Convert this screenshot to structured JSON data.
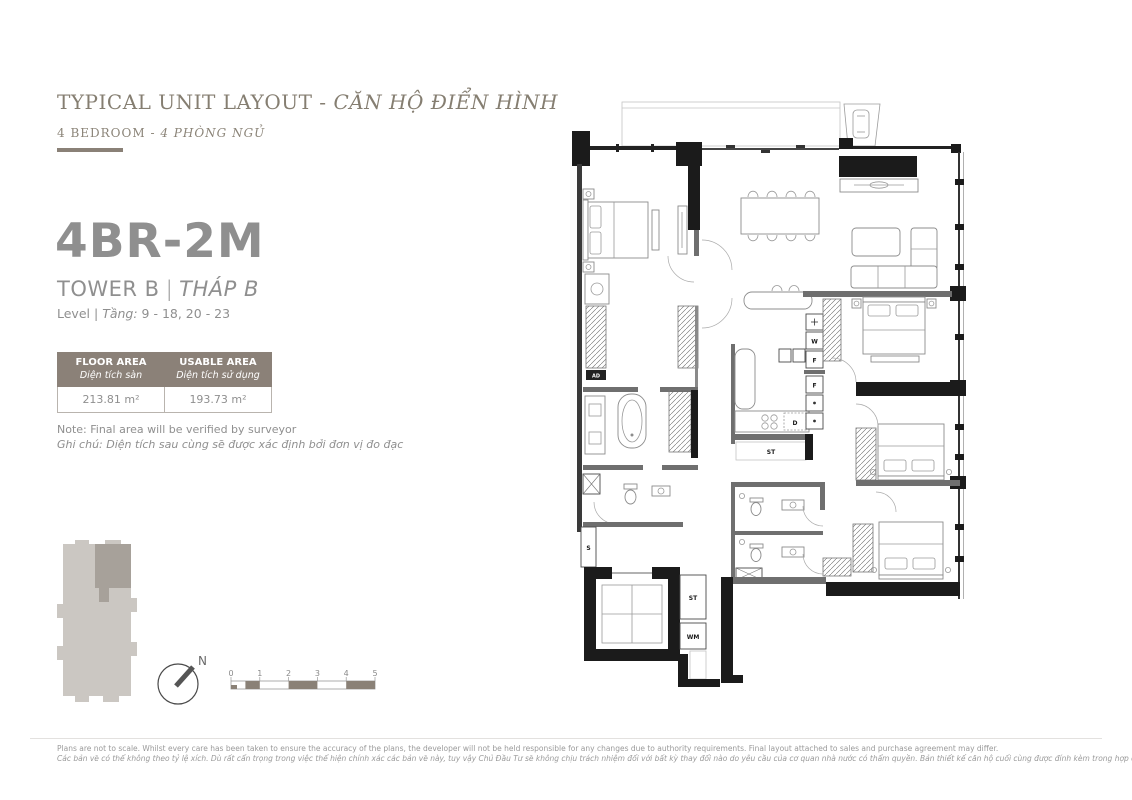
{
  "header": {
    "title_en": "TYPICAL UNIT LAYOUT",
    "title_divider": " - ",
    "title_vi": "CĂN HỘ ĐIỂN HÌNH",
    "subtitle_en": "4 BEDROOM",
    "subtitle_divider": " - ",
    "subtitle_vi": "4 PHÒNG NGỦ"
  },
  "unit": {
    "code": "4BR-2M",
    "tower_en": "TOWER B",
    "tower_sep": "|",
    "tower_vi": "THÁP B",
    "level_en": "Level",
    "level_sep": "|",
    "level_vi": "Tầng:",
    "level_value": "9 - 18, 20 - 23"
  },
  "area_table": {
    "col1": {
      "header_en": "FLOOR AREA",
      "header_vi": "Diện tích sàn",
      "value": "213.81 m²"
    },
    "col2": {
      "header_en": "USABLE AREA",
      "header_vi": "Diện tích sử dụng",
      "value": "193.73 m²"
    }
  },
  "notes": {
    "en": "Note: Final area will be verified by surveyor",
    "vi": "Ghi chú: Diện tích sau cùng sẽ được xác định bởi đơn vị đo đạc"
  },
  "plan_labels": {
    "w": "W",
    "f_upper": "F",
    "f_lower": "F",
    "d": "D",
    "st_kitchen": "ST",
    "st_store": "ST",
    "wm": "WM",
    "s": "S",
    "ad": "AD"
  },
  "compass": {
    "north": "N"
  },
  "scalebar": {
    "ticks": [
      "0",
      "1",
      "2",
      "3",
      "4",
      "5"
    ]
  },
  "footer": {
    "line_en": "Plans are not to scale. Whilst every care has been taken to ensure the accuracy of the plans, the developer will not be held responsible for any changes due to authority requirements. Final layout attached to sales and purchase agreement may differ.",
    "line_vi": "Các bản vẽ có thể không theo tỷ lệ xích. Dù rất cẩn trọng trong việc thể hiện chính xác các bản vẽ này, tuy vậy Chủ Đầu Tư sẽ không chịu trách nhiệm đối với bất kỳ thay đổi nào do yêu cầu của cơ quan nhà nước có thẩm quyền. Bản thiết kế căn hộ cuối cùng được đính kèm trong hợp đồng mua bán có thể có sự khác biệt so với bản thiết kế này."
  },
  "colors": {
    "accent": "#8a8177",
    "text_gray": "#8f8f8f",
    "plan_black": "#1b1b1b"
  }
}
